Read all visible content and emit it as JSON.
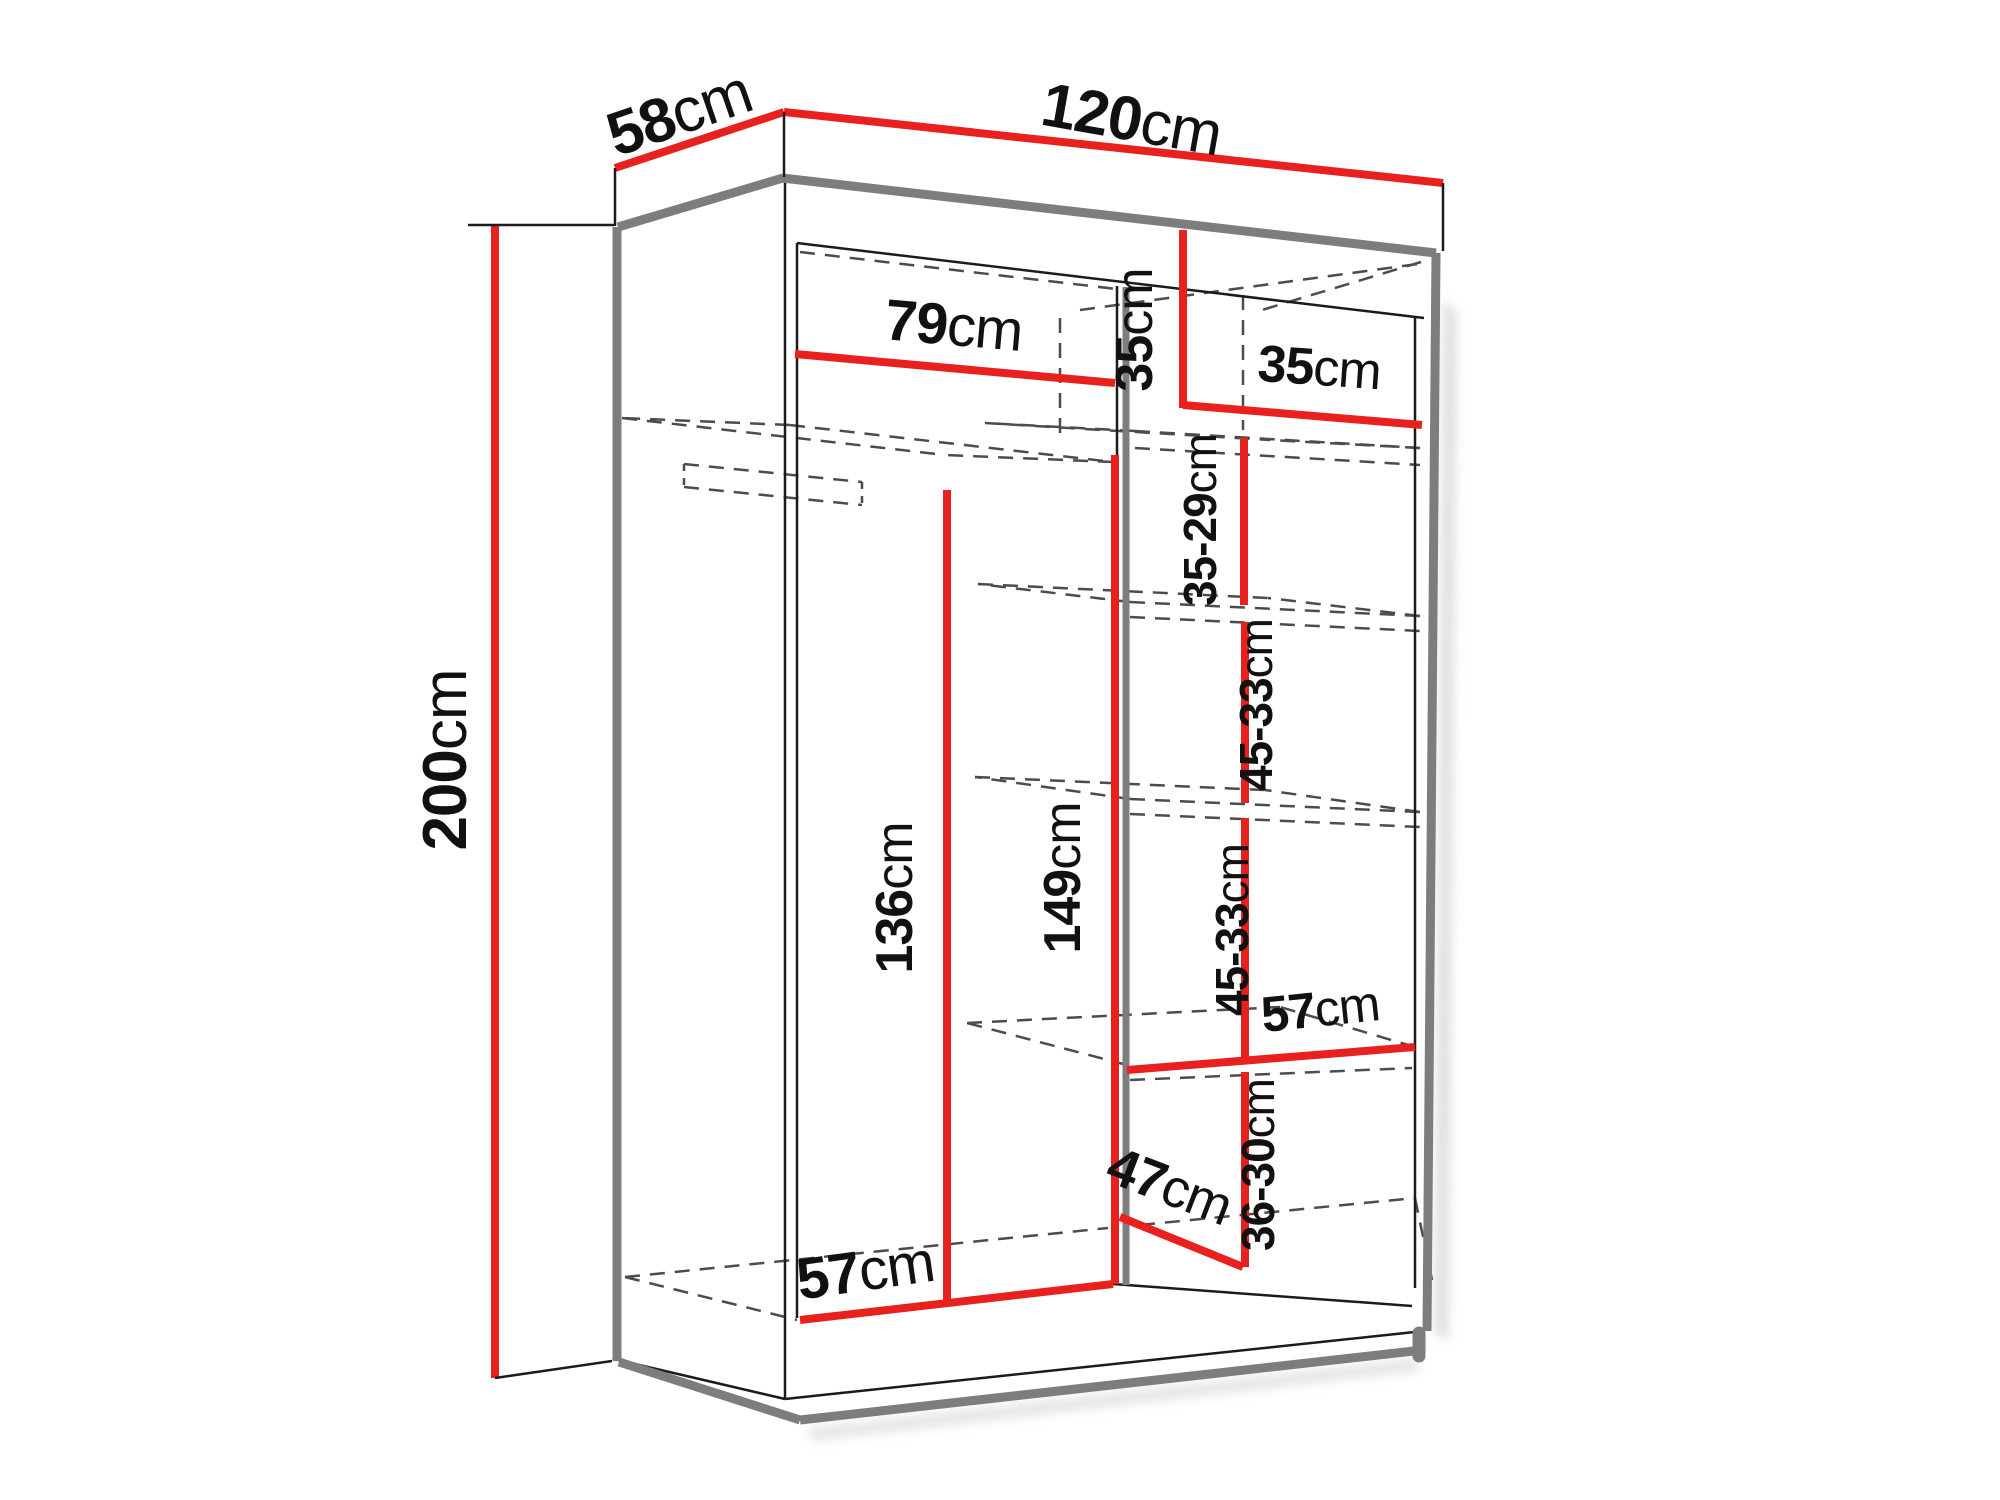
{
  "diagram": {
    "type": "wardrobe-dimension-diagram",
    "unit": "cm",
    "colors": {
      "dimension_line": "#e8201e",
      "outline": "#7d7d7d",
      "thin_line": "#1b1b1b",
      "hidden_line": "#4c4c4c",
      "background": "#ffffff",
      "text": "#111111"
    },
    "labels": {
      "depth": {
        "value": "58",
        "unit": "cm"
      },
      "width": {
        "value": "120",
        "unit": "cm"
      },
      "height": {
        "value": "200",
        "unit": "cm"
      },
      "left_width": {
        "value": "79",
        "unit": "cm"
      },
      "top_right_height": {
        "value": "35",
        "unit": "cm"
      },
      "top_right_width": {
        "value": "35",
        "unit": "cm"
      },
      "gap1": {
        "value": "35-29",
        "unit": "cm"
      },
      "gap2": {
        "value": "45-33",
        "unit": "cm"
      },
      "gap3": {
        "value": "45-33",
        "unit": "cm"
      },
      "shelf_width": {
        "value": "57",
        "unit": "cm"
      },
      "bottom_right_height": {
        "value": "36-30",
        "unit": "cm"
      },
      "bottom_depth": {
        "value": "47",
        "unit": "cm"
      },
      "rod_height": {
        "value": "136",
        "unit": "cm"
      },
      "partition_height": {
        "value": "149",
        "unit": "cm"
      },
      "bottom_width": {
        "value": "57",
        "unit": "cm"
      }
    }
  }
}
